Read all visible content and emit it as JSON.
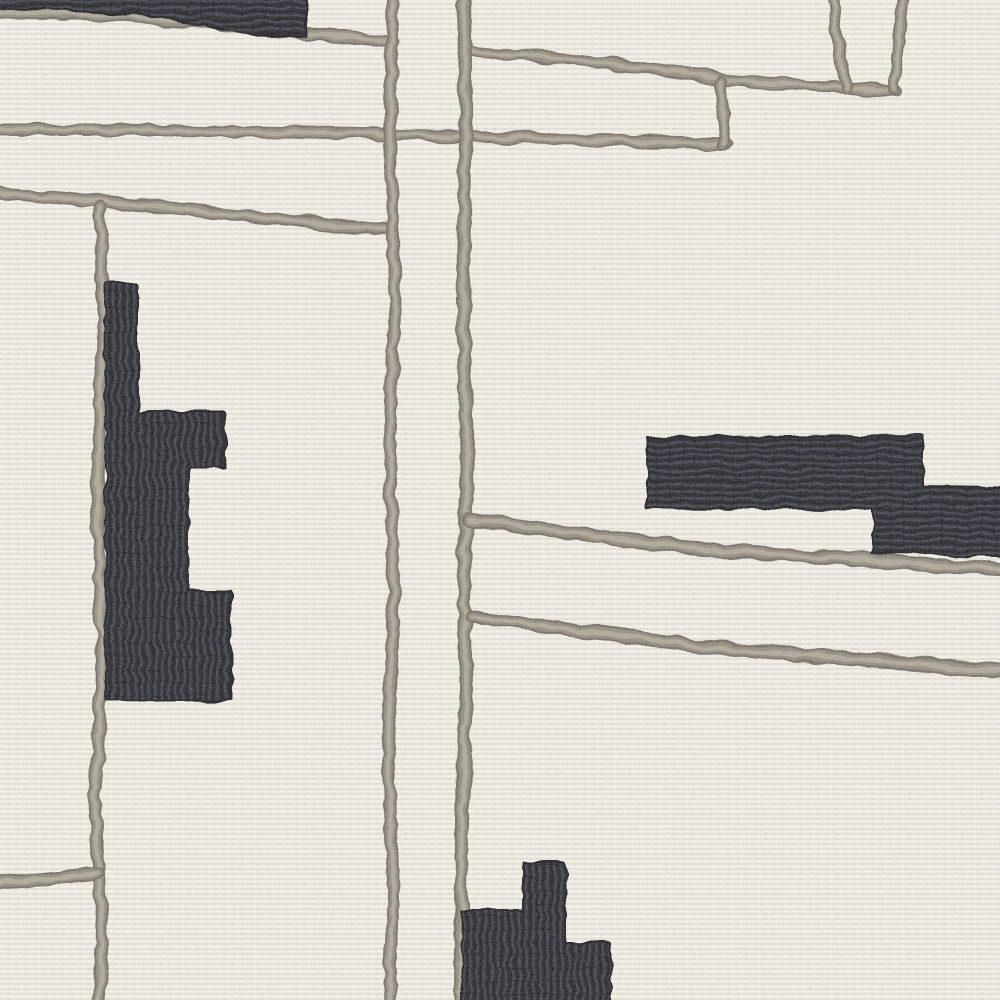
{
  "scene": {
    "description": "Close-up of a cream hand-tufted rug with abstract pattern: raised taupe-gray cord lines in a loose grid and dark charcoal-navy stepped blocks",
    "canvas": {
      "width": 1000,
      "height": 1000
    },
    "palette": {
      "cream_base": "#e9e6dc",
      "cream_light": "#f4f1e8",
      "cream_shadow": "#d8d4c9",
      "cord_dark": "#6f6a5f",
      "cord_mid": "#8d8779",
      "cord_light": "#aba596",
      "ink_base": "#24252c",
      "ink_rib": "#3b3e47",
      "ink_deep": "#15161b"
    },
    "lines": [
      {
        "name": "top-left-underline",
        "width": 13,
        "points": [
          [
            -6,
            12
          ],
          [
            100,
            14
          ],
          [
            200,
            22
          ],
          [
            308,
            34
          ],
          [
            393,
            42
          ]
        ]
      },
      {
        "name": "upper-cross-line",
        "width": 12,
        "points": [
          [
            -6,
            130
          ],
          [
            180,
            130
          ],
          [
            388,
            134
          ],
          [
            468,
            137
          ],
          [
            600,
            140
          ],
          [
            727,
            144
          ]
        ]
      },
      {
        "name": "top-diagonal",
        "width": 12,
        "points": [
          [
            467,
            50
          ],
          [
            560,
            58
          ],
          [
            660,
            70
          ],
          [
            728,
            80
          ],
          [
            800,
            85
          ],
          [
            848,
            88
          ],
          [
            897,
            91
          ]
        ]
      },
      {
        "name": "quad-connector",
        "width": 12,
        "points": [
          [
            722,
            82
          ],
          [
            724,
            144
          ]
        ]
      },
      {
        "name": "gate-left-edge",
        "width": 12,
        "points": [
          [
            833,
            -6
          ],
          [
            838,
            40
          ],
          [
            846,
            88
          ]
        ]
      },
      {
        "name": "gate-right-edge",
        "width": 12,
        "points": [
          [
            904,
            -6
          ],
          [
            898,
            45
          ],
          [
            894,
            90
          ]
        ]
      },
      {
        "name": "left-cross-line",
        "width": 13,
        "points": [
          [
            -6,
            192
          ],
          [
            150,
            206
          ],
          [
            290,
            220
          ],
          [
            393,
            231
          ]
        ]
      },
      {
        "name": "left-vertical",
        "width": 13,
        "points": [
          [
            100,
            208
          ],
          [
            104,
            340
          ],
          [
            97,
            500
          ],
          [
            103,
            650
          ],
          [
            95,
            800
          ],
          [
            102,
            930
          ],
          [
            99,
            1006
          ]
        ]
      },
      {
        "name": "center-vertical-left",
        "width": 13,
        "points": [
          [
            392,
            -6
          ],
          [
            390,
            150
          ],
          [
            395,
            300
          ],
          [
            389,
            450
          ],
          [
            394,
            600
          ],
          [
            388,
            760
          ],
          [
            393,
            880
          ],
          [
            389,
            1006
          ]
        ]
      },
      {
        "name": "center-vertical-right",
        "width": 14,
        "points": [
          [
            464,
            -6
          ],
          [
            466,
            140
          ],
          [
            463,
            300
          ],
          [
            467,
            450
          ],
          [
            464,
            560
          ],
          [
            466,
            690
          ],
          [
            462,
            820
          ],
          [
            461,
            1006
          ]
        ]
      },
      {
        "name": "mid-right-diagonal",
        "width": 14,
        "points": [
          [
            469,
            519
          ],
          [
            600,
            537
          ],
          [
            700,
            549
          ],
          [
            850,
            559
          ],
          [
            1006,
            570
          ]
        ]
      },
      {
        "name": "lower-right-diagonal",
        "width": 14,
        "points": [
          [
            471,
            617
          ],
          [
            600,
            633
          ],
          [
            700,
            646
          ],
          [
            850,
            659
          ],
          [
            1006,
            671
          ]
        ]
      },
      {
        "name": "bottom-left-spur",
        "width": 13,
        "points": [
          [
            -6,
            882
          ],
          [
            50,
            879
          ],
          [
            98,
            874
          ]
        ]
      }
    ],
    "shapes": [
      {
        "name": "top-left-block",
        "rib": "h",
        "points": [
          [
            -6,
            -6
          ],
          [
            306,
            -6
          ],
          [
            306,
            36
          ],
          [
            252,
            35
          ],
          [
            160,
            17
          ],
          [
            60,
            10
          ],
          [
            -6,
            8
          ]
        ]
      },
      {
        "name": "left-block",
        "rib": "v",
        "points": [
          [
            105,
            283
          ],
          [
            138,
            283
          ],
          [
            138,
            412
          ],
          [
            225,
            412
          ],
          [
            225,
            468
          ],
          [
            188,
            468
          ],
          [
            188,
            590
          ],
          [
            231,
            590
          ],
          [
            231,
            700
          ],
          [
            106,
            701
          ]
        ]
      },
      {
        "name": "right-block",
        "rib": "h",
        "points": [
          [
            647,
            437
          ],
          [
            923,
            435
          ],
          [
            923,
            486
          ],
          [
            1006,
            487
          ],
          [
            1006,
            558
          ],
          [
            873,
            552
          ],
          [
            873,
            509
          ],
          [
            647,
            508
          ]
        ]
      },
      {
        "name": "bottom-block",
        "rib": "v",
        "points": [
          [
            523,
            862
          ],
          [
            566,
            862
          ],
          [
            566,
            943
          ],
          [
            611,
            943
          ],
          [
            611,
            1006
          ],
          [
            462,
            1006
          ],
          [
            462,
            910
          ],
          [
            523,
            910
          ]
        ]
      }
    ]
  }
}
